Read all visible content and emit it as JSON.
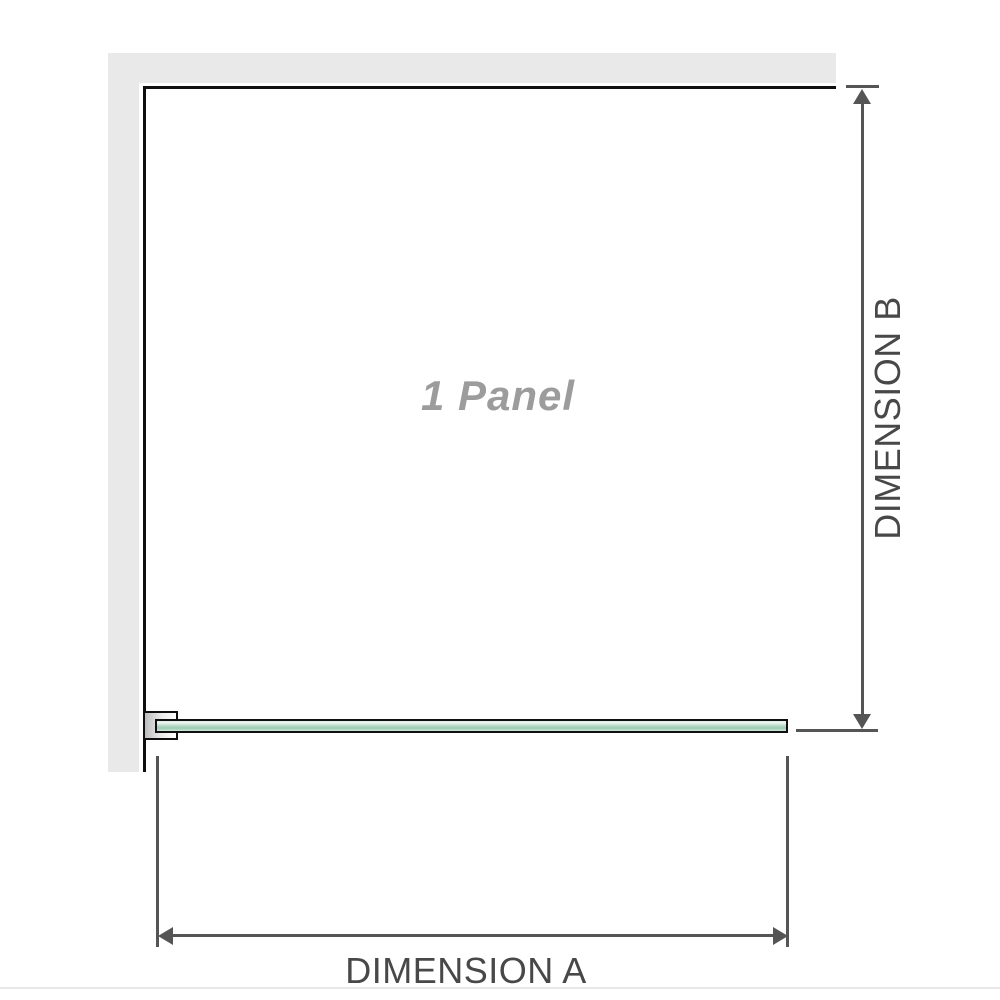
{
  "diagram": {
    "panel_label": "1 Panel",
    "dimension_a_label": "DIMENSION A",
    "dimension_b_label": "DIMENSION B"
  },
  "icons": {
    "arrow_up": "css-triangle-up",
    "arrow_down": "css-triangle-down",
    "arrow_left": "css-triangle-left",
    "arrow_right": "css-triangle-right"
  },
  "colors": {
    "wall": "#e9e9e9",
    "panel_outline": "#0f0f0f",
    "dimension_line": "#555555",
    "dimension_text": "#484848",
    "panel_label_text": "#9c9c9c",
    "glass_highlight": "#eef8f2",
    "glass_mid": "#9bcbb1",
    "glass_edge_light": "#cde8d9",
    "bottom_divider": "#e8e8e8"
  }
}
